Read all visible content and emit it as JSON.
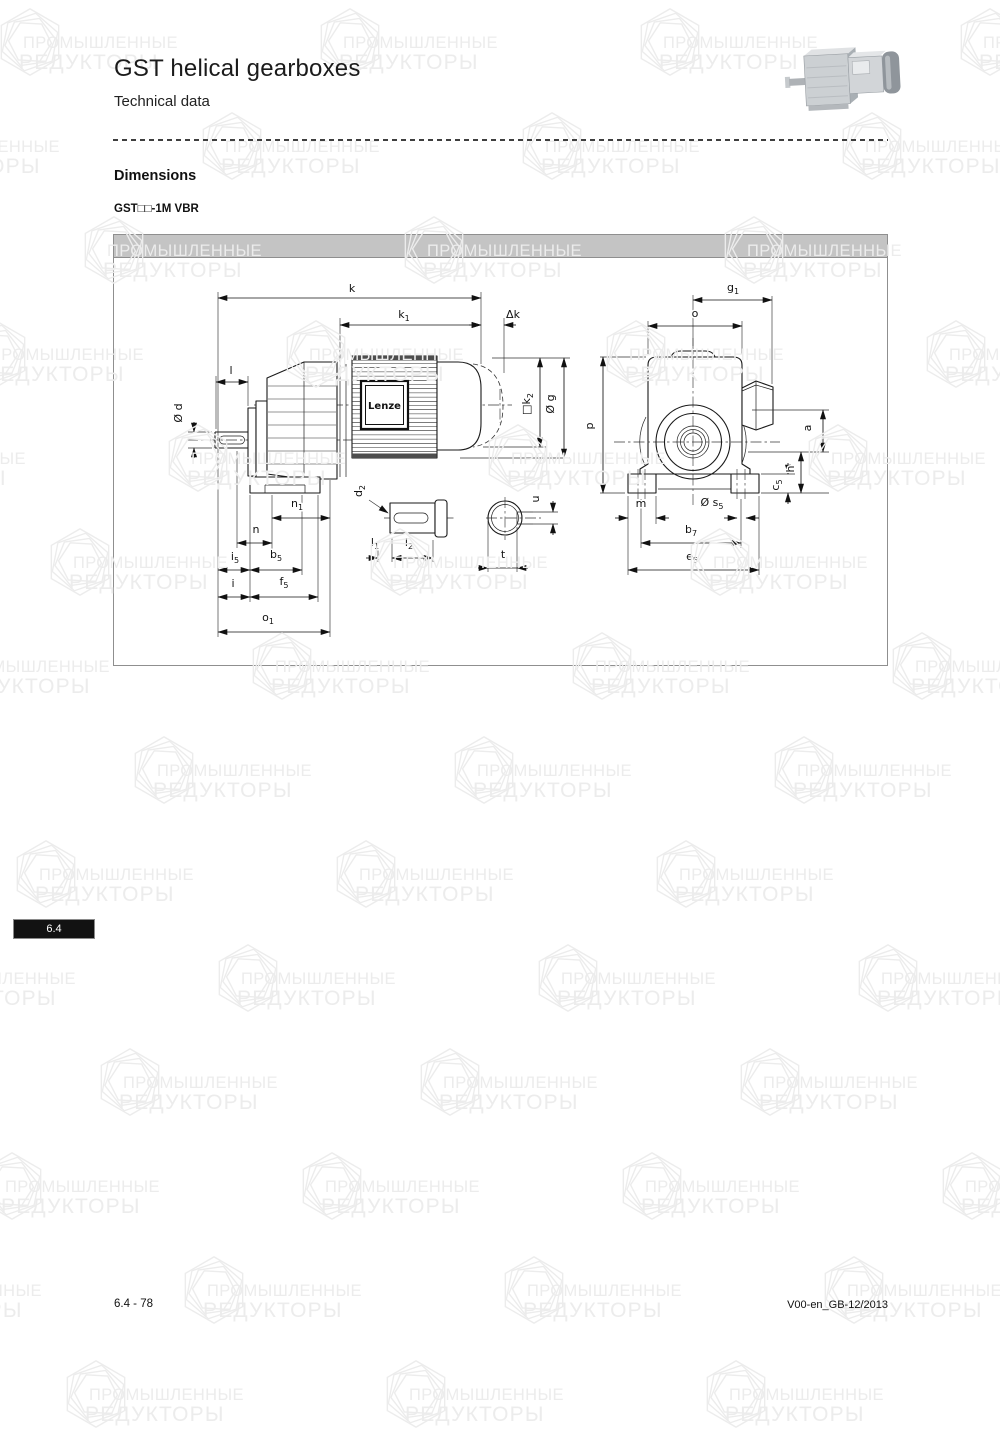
{
  "page": {
    "title": "GST helical gearboxes",
    "subtitle": "Technical data",
    "section_heading": "Dimensions",
    "model_label": "GST□□-1M VBR",
    "side_tab": "6.4",
    "footer_left": "6.4 - 78",
    "footer_right": "V00-en_GB-12/2013"
  },
  "watermark": {
    "line1": "ПРОМЫШЛЕННЫЕ",
    "line2": "РЕДУКТОРЫ"
  },
  "drawing": {
    "brand_label": "Lenze",
    "dimension_labels": [
      {
        "id": "k",
        "t": "k",
        "s": "",
        "x": 352,
        "y": 292,
        "r": 0
      },
      {
        "id": "k1",
        "t": "k",
        "s": "1",
        "x": 404,
        "y": 318,
        "r": 0
      },
      {
        "id": "delta-k",
        "t": "Δk",
        "s": "",
        "x": 513,
        "y": 318,
        "r": 0
      },
      {
        "id": "l",
        "t": "l",
        "s": "",
        "x": 231,
        "y": 374,
        "r": 0
      },
      {
        "id": "d",
        "t": "Ø d",
        "s": "",
        "x": 182,
        "y": 413,
        "r": -90
      },
      {
        "id": "k2",
        "t": "□k",
        "s": "2",
        "x": 530,
        "y": 404,
        "r": -90
      },
      {
        "id": "g",
        "t": "Ø g",
        "s": "",
        "x": 554,
        "y": 404,
        "r": -90
      },
      {
        "id": "n1",
        "t": "n",
        "s": "1",
        "x": 297,
        "y": 507,
        "r": 0
      },
      {
        "id": "n",
        "t": "n",
        "s": "",
        "x": 256,
        "y": 533,
        "r": 0
      },
      {
        "id": "i5",
        "t": "i",
        "s": "5",
        "x": 235,
        "y": 560,
        "r": 0
      },
      {
        "id": "b5",
        "t": "b",
        "s": "5",
        "x": 276,
        "y": 558,
        "r": 0
      },
      {
        "id": "i",
        "t": "i",
        "s": "",
        "x": 233,
        "y": 587,
        "r": 0
      },
      {
        "id": "f5",
        "t": "f",
        "s": "5",
        "x": 284,
        "y": 585,
        "r": 0
      },
      {
        "id": "o1",
        "t": "o",
        "s": "1",
        "x": 268,
        "y": 621,
        "r": 0
      },
      {
        "id": "d2",
        "t": "d",
        "s": "2",
        "x": 362,
        "y": 491,
        "r": -90
      },
      {
        "id": "l1",
        "t": "l",
        "s": "1",
        "x": 375,
        "y": 546,
        "r": 0
      },
      {
        "id": "l2",
        "t": "l",
        "s": "2",
        "x": 409,
        "y": 546,
        "r": 0
      },
      {
        "id": "u",
        "t": "u",
        "s": "",
        "x": 539,
        "y": 499,
        "r": -90
      },
      {
        "id": "t",
        "t": "t",
        "s": "",
        "x": 503,
        "y": 558,
        "r": 0
      },
      {
        "id": "g1",
        "t": "g",
        "s": "1",
        "x": 733,
        "y": 291,
        "r": 0
      },
      {
        "id": "o",
        "t": "o",
        "s": "",
        "x": 695,
        "y": 317,
        "r": 0
      },
      {
        "id": "p",
        "t": "p",
        "s": "",
        "x": 593,
        "y": 426,
        "r": -90
      },
      {
        "id": "a",
        "t": "a",
        "s": "",
        "x": 811,
        "y": 428,
        "r": -90
      },
      {
        "id": "h",
        "t": "h",
        "s": "",
        "x": 794,
        "y": 469,
        "r": -90
      },
      {
        "id": "c5",
        "t": "c",
        "s": "5",
        "x": 779,
        "y": 485,
        "r": -90
      },
      {
        "id": "m",
        "t": "m",
        "s": "",
        "x": 641,
        "y": 507,
        "r": 0
      },
      {
        "id": "s5",
        "t": "Ø s",
        "s": "5",
        "x": 712,
        "y": 506,
        "r": 0
      },
      {
        "id": "b7",
        "t": "b",
        "s": "7",
        "x": 691,
        "y": 533,
        "r": 0
      },
      {
        "id": "e5",
        "t": "e",
        "s": "5",
        "x": 692,
        "y": 560,
        "r": 0
      }
    ]
  },
  "colors": {
    "panel_header": "#c4c4c4",
    "side_tab_bg": "#121212",
    "line": "#1a1a1a",
    "watermark": "#ececec"
  }
}
